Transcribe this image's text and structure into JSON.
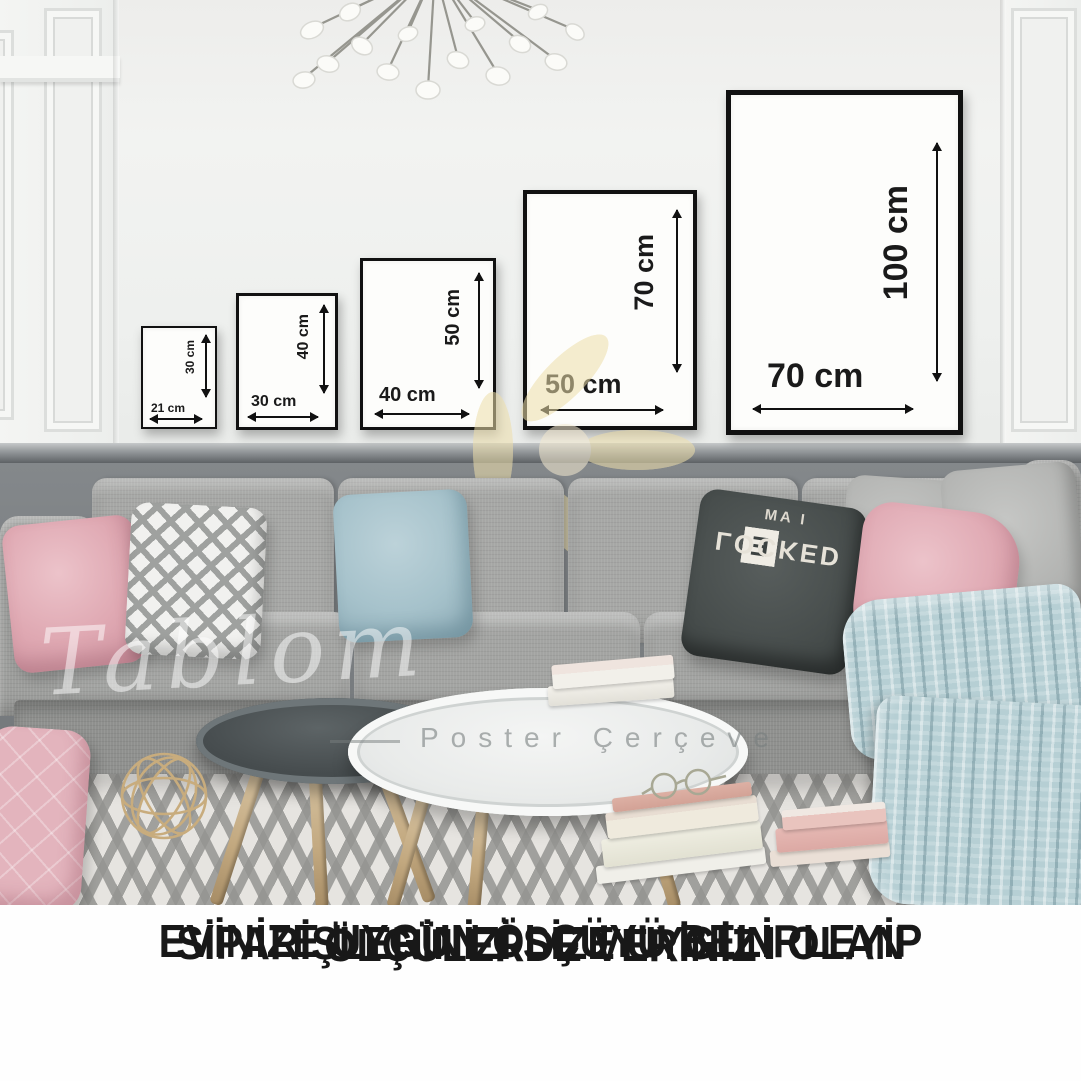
{
  "frames": [
    {
      "width_label": "21 cm",
      "height_label": "30 cm"
    },
    {
      "width_label": "30 cm",
      "height_label": "40 cm"
    },
    {
      "width_label": "40 cm",
      "height_label": "50 cm"
    },
    {
      "width_label": "50 cm",
      "height_label": "70 cm"
    },
    {
      "width_label": "70 cm",
      "height_label": "100 cm"
    }
  ],
  "pillow": {
    "top_text": "I AM",
    "tiles": [
      "S",
      "H",
      "E"
    ],
    "bottom_text": "LOCKED"
  },
  "watermark": {
    "brand": "Tablom",
    "tagline": "Poster  Çerçeve"
  },
  "caption": {
    "line1": "EVİNİZE UYGUN ÖLÇÜYÜ BELİRLEYİP",
    "line2": "SİPARİŞLERİNİZİ SİZE UYGUN OLAN",
    "line3": "ÖLÇÜLERDE VERİNİZ"
  },
  "colors": {
    "wall": "#f0f1ef",
    "wainscot_gray": "#7d8184",
    "frame_black": "#111111",
    "sofa_gray": "#a3a4a2",
    "pillow_pink": "#dfa8b2",
    "pillow_blue": "#a6c2cb",
    "pillow_charcoal": "#484e4d",
    "blanket_blue": "#b6cfd4",
    "rug_base": "#e6e4e0",
    "rug_stripe": "#949491",
    "wood_leg": "#c2a87f",
    "gold_wire": "#c8ac7d",
    "caption_text": "#181818",
    "watermark_yellow": "#eedfab"
  }
}
